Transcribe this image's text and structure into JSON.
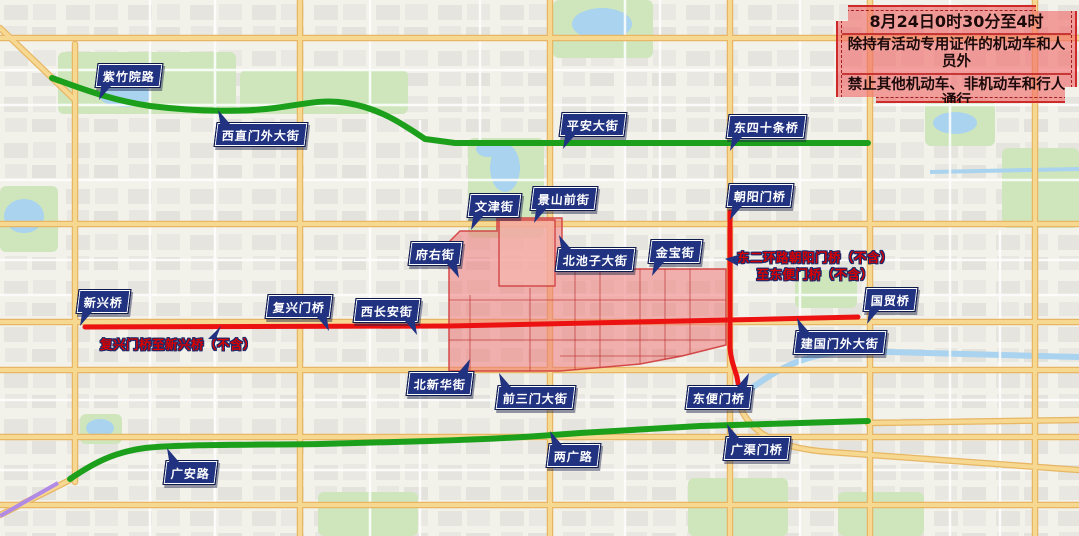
{
  "banner": {
    "line1": "8月24日0时30分至4时",
    "line2": "除持有活动专用证件的机动车和人员外",
    "line3": "禁止其他机动车、非机动车和行人通行"
  },
  "notes": {
    "changan": "复兴门桥至新兴桥（不含）",
    "ring2_line1": "东二环路朝阳门桥（不含）",
    "ring2_line2": "至东便门桥（不含）"
  },
  "road_labels": [
    {
      "label": "紫竹院路"
    },
    {
      "label": "西直门外大街"
    },
    {
      "label": "平安大街"
    },
    {
      "label": "东四十条桥"
    },
    {
      "label": "朝阳门桥"
    },
    {
      "label": "文津街"
    },
    {
      "label": "景山前街"
    },
    {
      "label": "府右街"
    },
    {
      "label": "北池子大街"
    },
    {
      "label": "金宝街"
    },
    {
      "label": "新兴桥"
    },
    {
      "label": "复兴门桥"
    },
    {
      "label": "西长安街"
    },
    {
      "label": "国贸桥"
    },
    {
      "label": "建国门外大街"
    },
    {
      "label": "北新华街"
    },
    {
      "label": "前三门大街"
    },
    {
      "label": "东便门桥"
    },
    {
      "label": "广渠门桥"
    },
    {
      "label": "两广路"
    },
    {
      "label": "广安路"
    }
  ],
  "colors": {
    "label_background": "#203280",
    "restricted_zone_fill": "#ee7878",
    "closed_route_red": "#ed1212",
    "open_route_green": "#1ca01c",
    "banner_border_red": "#cf2a2a",
    "note_text_red": "#d80000"
  }
}
